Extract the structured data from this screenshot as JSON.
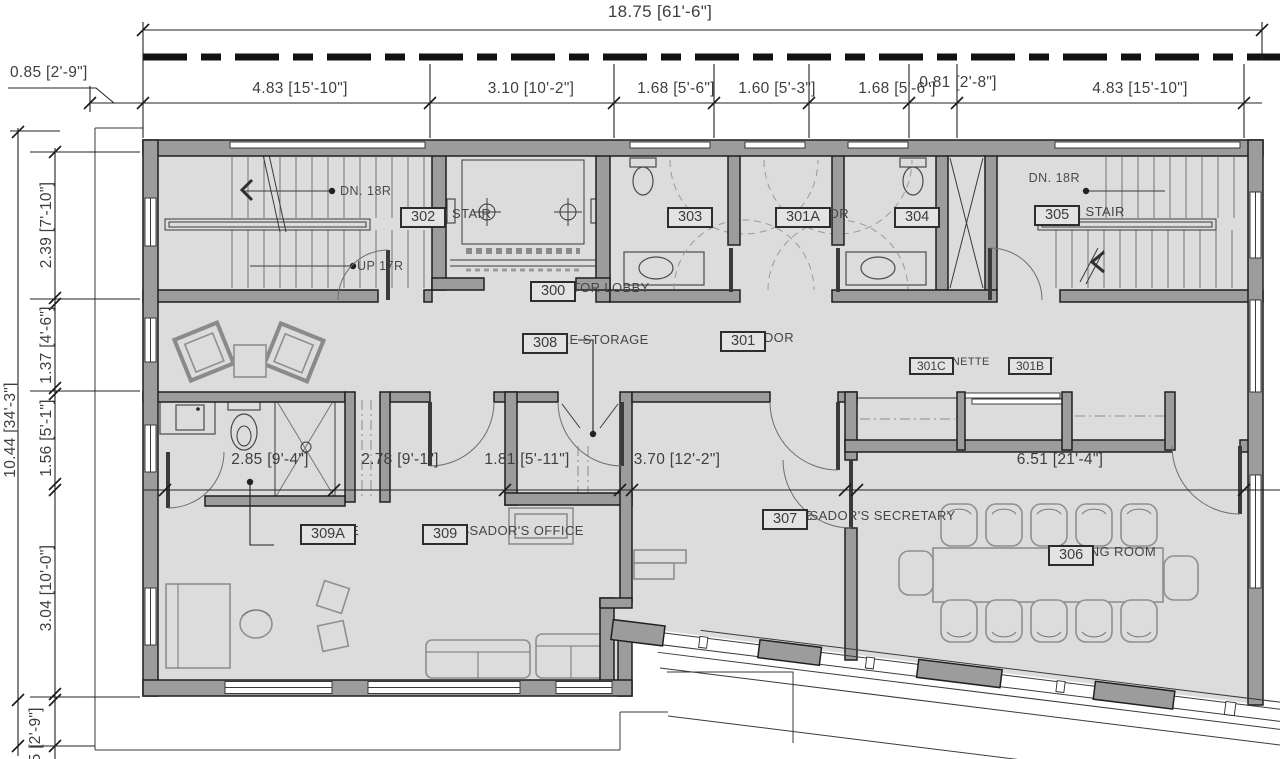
{
  "dims": {
    "top_overall": "18.75 [61'-6\"]",
    "top_offset_left": "0.85 [2'-9\"]",
    "top_row": [
      "4.83 [15'-10\"]",
      "3.10 [10'-2\"]",
      "1.68 [5'-6\"]",
      "1.60 [5'-3\"]",
      "1.68 [5'-6\"]",
      "0.81 [2'-8\"]",
      "4.83 [15'-10\"]"
    ],
    "left_overall": "10.44 [34'-3\"]",
    "left_col": [
      "2.39 [7'-10\"]",
      "1.37 [4'-6\"]",
      "1.56 [5'-1\"]",
      "3.04 [10'-0\"]"
    ],
    "left_bottom_offset": "0.85 [2'-9\"]",
    "mid_row": [
      "2.85 [9'-4\"]",
      "2.78 [9'-1\"]",
      "1.81 [5'-11\"]",
      "3.70 [12'-2\"]",
      "6.51 [21'-4\"]"
    ]
  },
  "rooms": {
    "north_stair": {
      "name": "NORTH STAIR",
      "number": "302"
    },
    "elevator_lobby": {
      "name": "ELEVATOR LOBBY",
      "number": "300"
    },
    "wr_west": {
      "name": "W.R.",
      "number": "303"
    },
    "corridor_a": {
      "name": "CORRIDOR",
      "number": "301A"
    },
    "wr_east": {
      "name": "W.R.",
      "number": "304"
    },
    "south_stair": {
      "name": "SOUTH STAIR",
      "number": "305"
    },
    "secure_storage": {
      "name": "SECURE STORAGE",
      "number": "308"
    },
    "corridor": {
      "name": "CORRIDOR",
      "number": "301"
    },
    "kitchenette": {
      "name": "KITCHENETTE",
      "number": "301C"
    },
    "closet": {
      "name": "CLOSET",
      "number": "301B"
    },
    "ensuite": {
      "name": "ENSUITE",
      "number": "309A"
    },
    "ambassadors_office": {
      "name": "AMBASSADOR'S OFFICE",
      "number": "309"
    },
    "office_secretary": {
      "name_line1": "OFFICE",
      "name_line2": "AMBASSADOR'S SECRETARY",
      "number": "307"
    },
    "meeting_room": {
      "name": "MEETING ROOM",
      "number": "306"
    }
  },
  "annotations": {
    "north_stair_down": "DN. 18R",
    "north_stair_up": "UP 17R",
    "south_stair_down": "DN. 18R"
  },
  "colors": {
    "floor": "#dcdcdc",
    "wall": "#9c9c9c",
    "line": "#1f1f1f",
    "text": "#454545"
  }
}
